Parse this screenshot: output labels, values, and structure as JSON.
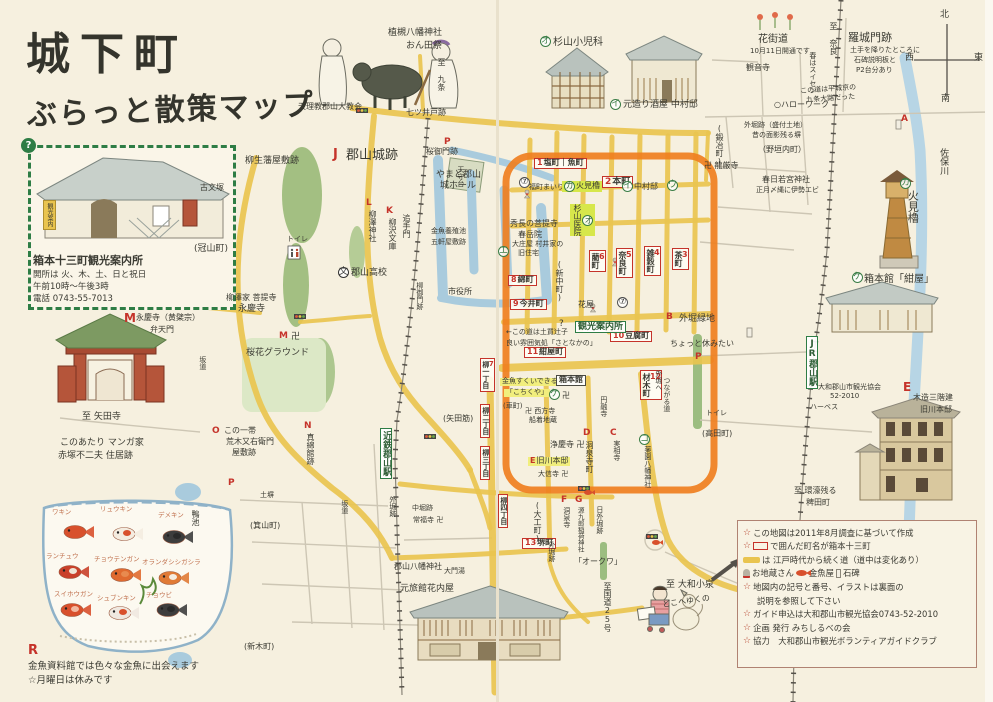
{
  "title": {
    "l1": "城下町",
    "l2": "ぶらっと散策マップ"
  },
  "accent_colors": {
    "road_yellow": "#e9c44f",
    "highlight_orange": "#ef7f1f",
    "box_red": "#c5332a",
    "sign_green": "#2e7d45",
    "water_blue": "#a9cbdd"
  },
  "info": {
    "name": "箱本十三町観光案内所",
    "l1": "開所は 火、木、土、日と祝日",
    "l2": "午前10時～午後3時",
    "l3": "電話 0743-55-7013",
    "banner": "観光案内",
    "q": "?"
  },
  "goldfish": {
    "note_letter": "R",
    "note1": "金魚資料館では色々な金魚に出会えます",
    "note2": "☆月曜日は休みです",
    "fish": [
      {
        "name": "ワキン",
        "lx": 52,
        "ly": 506,
        "fx": 75,
        "fy": 532,
        "c1": "#d8502c",
        "c2": "#d8502c"
      },
      {
        "name": "リュウキン",
        "lx": 100,
        "ly": 503,
        "fx": 124,
        "fy": 534,
        "c1": "#f4ece0",
        "c2": "#d8502c"
      },
      {
        "name": "デメキン",
        "lx": 158,
        "ly": 509,
        "fx": 174,
        "fy": 537,
        "c1": "#3d3d3d",
        "c2": "#2a2a2a"
      },
      {
        "name": "ランチュウ",
        "lx": 46,
        "ly": 550,
        "fx": 70,
        "fy": 572,
        "c1": "#c9402a",
        "c2": "#efe5d5"
      },
      {
        "name": "チョウテンガン",
        "lx": 94,
        "ly": 553,
        "fx": 122,
        "fy": 575,
        "c1": "#e06a2f",
        "c2": "#e88a4f"
      },
      {
        "name": "オランダシシガシラ",
        "lx": 142,
        "ly": 556,
        "fx": 170,
        "fy": 578,
        "c1": "#e07a35",
        "c2": "#f4ece0"
      },
      {
        "name": "スイホウガン",
        "lx": 54,
        "ly": 588,
        "fx": 72,
        "fy": 610,
        "c1": "#d8502c",
        "c2": "#f2b8a0"
      },
      {
        "name": "シュブンキン",
        "lx": 97,
        "ly": 592,
        "fx": 120,
        "fy": 613,
        "c1": "#efe8e0",
        "c2": "#d8502c"
      },
      {
        "name": "チョウビ",
        "lx": 146,
        "ly": 589,
        "fx": 168,
        "fy": 610,
        "c1": "#3d3d3d",
        "c2": "#2a2a2a"
      }
    ]
  },
  "legend": {
    "rows": [
      [
        {
          "i": "star"
        },
        {
          "t": "この地図は2011年8月調査に基づいて作成"
        }
      ],
      [
        {
          "i": "star"
        },
        {
          "i": "rb"
        },
        {
          "t": "で囲んだ町名が箱本十三町"
        }
      ],
      [
        {
          "i": "yb"
        },
        {
          "t": "は 江戸時代から続く道（道中は変化あり）"
        }
      ],
      [
        {
          "i": "jz"
        },
        {
          "t": "お地蔵さん"
        },
        {
          "i": "gf"
        },
        {
          "t": "金魚屋"
        },
        {
          "i": "st"
        },
        {
          "t": "石碑"
        }
      ],
      [
        {
          "i": "star"
        },
        {
          "t": "地図内の記号と番号、イラストは裏面の"
        }
      ],
      [
        {
          "t": "説明を参照して下さい",
          "ind": true
        }
      ],
      [
        {
          "i": "star"
        },
        {
          "t": "ガイド申込は大和郡山市観光協会0743-52-2010"
        }
      ],
      [
        {
          "i": "star"
        },
        {
          "t": "企画 発行 みちしるべの会"
        }
      ],
      [
        {
          "i": "star"
        },
        {
          "t": "協力　大和郡山市観光ボランティアガイドクラブ"
        }
      ]
    ]
  },
  "map_labels": [
    {
      "t": "至 九条",
      "x": 436,
      "y": 58,
      "k": "pv",
      "s": 8
    },
    {
      "t": "植槻八幡神社",
      "x": 388,
      "y": 28,
      "s": 9
    },
    {
      "t": "おん田祭",
      "x": 406,
      "y": 41,
      "s": 9
    },
    {
      "t": "天理教郡山大教会",
      "x": 298,
      "y": 103,
      "s": 8
    },
    {
      "t": "七ツ井戸跡",
      "x": 406,
      "y": 109,
      "s": 8
    },
    {
      "t": "オ",
      "x": 540,
      "y": 36,
      "k": "cg"
    },
    {
      "t": "杉山小児科",
      "x": 553,
      "y": 37,
      "s": 10
    },
    {
      "t": "イ",
      "x": 610,
      "y": 99,
      "k": "cg"
    },
    {
      "t": "元造り酒屋 中村邸",
      "x": 623,
      "y": 100,
      "s": 9
    },
    {
      "t": "卍 龍厳寺",
      "x": 704,
      "y": 162,
      "s": 8
    },
    {
      "t": "(鍛冶町)",
      "x": 714,
      "y": 124,
      "k": "pv",
      "s": 8
    },
    {
      "t": "花街道",
      "x": 758,
      "y": 34,
      "s": 10
    },
    {
      "t": "10月11日開通です",
      "x": 750,
      "y": 48,
      "s": 7
    },
    {
      "t": "観音寺",
      "x": 746,
      "y": 64,
      "s": 8
    },
    {
      "t": "春はスイセン",
      "x": 808,
      "y": 52,
      "k": "pv",
      "s": 7
    },
    {
      "t": "○ハローワーク",
      "x": 774,
      "y": 101,
      "s": 8
    },
    {
      "t": "この道は平城京の",
      "x": 800,
      "y": 88,
      "s": 7,
      "r": -4
    },
    {
      "t": "九条大路だった",
      "x": 806,
      "y": 97,
      "s": 7,
      "r": -4
    },
    {
      "t": "至 奈良",
      "x": 828,
      "y": 22,
      "k": "pv",
      "s": 8
    },
    {
      "t": "羅城門跡",
      "x": 848,
      "y": 32,
      "s": 11
    },
    {
      "t": "土手を降りたところに",
      "x": 850,
      "y": 47,
      "s": 7
    },
    {
      "t": "石碑説明板と",
      "x": 854,
      "y": 57,
      "s": 7
    },
    {
      "t": "P2台分あり",
      "x": 856,
      "y": 67,
      "s": 7
    },
    {
      "t": "A",
      "x": 901,
      "y": 114,
      "k": "rl"
    },
    {
      "t": "北",
      "x": 940,
      "y": 10,
      "s": 9
    },
    {
      "t": "西",
      "x": 905,
      "y": 53,
      "s": 9
    },
    {
      "t": "東",
      "x": 974,
      "y": 53,
      "s": 9
    },
    {
      "t": "南",
      "x": 941,
      "y": 94,
      "s": 9
    },
    {
      "t": "佐保川",
      "x": 938,
      "y": 148,
      "k": "pv",
      "s": 9
    },
    {
      "t": "外堀跡（盛付土地）",
      "x": 744,
      "y": 122,
      "s": 7
    },
    {
      "t": "昔の面影残る塀",
      "x": 752,
      "y": 132,
      "s": 7
    },
    {
      "t": "（野垣内町）",
      "x": 758,
      "y": 146,
      "s": 8
    },
    {
      "t": "春日若宮神社",
      "x": 762,
      "y": 176,
      "s": 8
    },
    {
      "t": "正月〆縄に伊勢エビ",
      "x": 756,
      "y": 187,
      "s": 7
    },
    {
      "t": "カ",
      "x": 900,
      "y": 178,
      "k": "cg"
    },
    {
      "t": "火見櫓",
      "x": 906,
      "y": 190,
      "k": "pv",
      "s": 11
    },
    {
      "t": "ケ",
      "x": 852,
      "y": 272,
      "k": "cg"
    },
    {
      "t": "箱本館「紺屋」",
      "x": 864,
      "y": 274,
      "s": 10
    },
    {
      "t": "E",
      "x": 903,
      "y": 381,
      "k": "rl",
      "s": 12
    },
    {
      "t": "木造三階建",
      "x": 913,
      "y": 394,
      "s": 8
    },
    {
      "t": "旧川本邸",
      "x": 920,
      "y": 406,
      "s": 8
    },
    {
      "t": "JR郡山駅",
      "x": 806,
      "y": 336,
      "k": "gbv",
      "s": 9
    },
    {
      "t": "大和郡山市観光協会",
      "x": 818,
      "y": 384,
      "s": 7
    },
    {
      "t": "52-2010",
      "x": 830,
      "y": 393,
      "s": 7
    },
    {
      "t": "ハーベス",
      "x": 810,
      "y": 404,
      "s": 7
    },
    {
      "t": "至 環濠残る",
      "x": 794,
      "y": 487,
      "s": 8
    },
    {
      "t": "稗田町",
      "x": 806,
      "y": 499,
      "s": 8
    },
    {
      "t": "柳生藩屋敷跡",
      "x": 245,
      "y": 156,
      "s": 9
    },
    {
      "t": "古文塚",
      "x": 200,
      "y": 184,
      "s": 8
    },
    {
      "t": "(冠山町)",
      "x": 194,
      "y": 244,
      "s": 9
    },
    {
      "t": "J",
      "x": 333,
      "y": 148,
      "k": "rl",
      "s": 13
    },
    {
      "t": "郡山城跡",
      "x": 346,
      "y": 149,
      "s": 13
    },
    {
      "t": "天守台",
      "x": 456,
      "y": 166,
      "k": "pv",
      "s": 7
    },
    {
      "t": "L",
      "x": 366,
      "y": 198,
      "k": "rl"
    },
    {
      "t": "柳澤神社",
      "x": 367,
      "y": 210,
      "k": "pv",
      "s": 8
    },
    {
      "t": "K",
      "x": 386,
      "y": 206,
      "k": "rl"
    },
    {
      "t": "柳沢文庫",
      "x": 387,
      "y": 218,
      "k": "pv",
      "s": 8
    },
    {
      "t": "追手門",
      "x": 401,
      "y": 214,
      "k": "pv",
      "s": 8
    },
    {
      "t": "P",
      "x": 444,
      "y": 137,
      "k": "rl"
    },
    {
      "t": "桜御門跡",
      "x": 426,
      "y": 148,
      "s": 8
    },
    {
      "t": "やまと郡山",
      "x": 436,
      "y": 170,
      "s": 9
    },
    {
      "t": "城ホール",
      "x": 440,
      "y": 181,
      "s": 9
    },
    {
      "t": "金魚養殖池",
      "x": 431,
      "y": 228,
      "s": 7
    },
    {
      "t": "五軒屋敷跡",
      "x": 431,
      "y": 239,
      "s": 7
    },
    {
      "t": "市役所",
      "x": 448,
      "y": 288,
      "s": 8
    },
    {
      "t": "柳御門跡",
      "x": 415,
      "y": 282,
      "k": "pv",
      "s": 7
    },
    {
      "t": "文",
      "x": 338,
      "y": 267,
      "k": "cb"
    },
    {
      "t": "郡山高校",
      "x": 351,
      "y": 268,
      "s": 9
    },
    {
      "t": "柳澤家 菩提寺",
      "x": 226,
      "y": 294,
      "s": 8
    },
    {
      "t": "永慶寺",
      "x": 238,
      "y": 304,
      "s": 9
    },
    {
      "t": "M",
      "x": 279,
      "y": 331,
      "k": "rl"
    },
    {
      "t": "卍",
      "x": 291,
      "y": 332,
      "s": 9
    },
    {
      "t": "M",
      "x": 124,
      "y": 312,
      "k": "rl",
      "s": 12
    },
    {
      "t": "永慶寺（黄檗宗）",
      "x": 136,
      "y": 314,
      "s": 8
    },
    {
      "t": "弁天門",
      "x": 150,
      "y": 326,
      "s": 8
    },
    {
      "t": "トイレ",
      "x": 287,
      "y": 236,
      "s": 7
    },
    {
      "t": "桜花グラウンド",
      "x": 246,
      "y": 348,
      "s": 9
    },
    {
      "t": "坂道",
      "x": 198,
      "y": 356,
      "k": "pv",
      "s": 7
    },
    {
      "t": "至 矢田寺",
      "x": 82,
      "y": 412,
      "s": 9
    },
    {
      "t": "このあたり マンガ家",
      "x": 60,
      "y": 438,
      "s": 9
    },
    {
      "t": "赤塚不二夫 住居跡",
      "x": 58,
      "y": 451,
      "s": 9
    },
    {
      "t": "O",
      "x": 212,
      "y": 426,
      "k": "rl"
    },
    {
      "t": "この一帯",
      "x": 224,
      "y": 427,
      "s": 8
    },
    {
      "t": "荒木又右衛門",
      "x": 226,
      "y": 438,
      "s": 8
    },
    {
      "t": "屋敷跡",
      "x": 232,
      "y": 449,
      "s": 8
    },
    {
      "t": "N",
      "x": 304,
      "y": 421,
      "k": "rl"
    },
    {
      "t": "真綿館跡",
      "x": 305,
      "y": 433,
      "k": "pv",
      "s": 8
    },
    {
      "t": "P",
      "x": 228,
      "y": 478,
      "k": "rl"
    },
    {
      "t": "土塀",
      "x": 260,
      "y": 492,
      "s": 7
    },
    {
      "t": "鴨池",
      "x": 190,
      "y": 510,
      "k": "pv",
      "s": 8
    },
    {
      "t": "(箕山町)",
      "x": 250,
      "y": 522,
      "s": 8
    },
    {
      "t": "近鉄郡山駅",
      "x": 380,
      "y": 428,
      "k": "gbv",
      "s": 9
    },
    {
      "t": "外堀跡",
      "x": 388,
      "y": 496,
      "k": "pv",
      "s": 7
    },
    {
      "t": "坂道",
      "x": 340,
      "y": 500,
      "k": "pv",
      "s": 7
    },
    {
      "t": "(矢田筋)",
      "x": 443,
      "y": 415,
      "s": 8
    },
    {
      "t": "中堀跡",
      "x": 412,
      "y": 505,
      "s": 7
    },
    {
      "t": "常福寺 卍",
      "x": 413,
      "y": 517,
      "s": 7
    },
    {
      "t": "郡山八幡神社",
      "x": 394,
      "y": 563,
      "s": 8
    },
    {
      "t": "大門湯",
      "x": 444,
      "y": 568,
      "s": 7
    },
    {
      "t": "元旅館花内屋",
      "x": 400,
      "y": 584,
      "s": 9
    },
    {
      "t": "(新木町)",
      "x": 244,
      "y": 643,
      "s": 8
    },
    {
      "n": "1",
      "t": "塩町｜魚町",
      "x": 534,
      "y": 158,
      "k": "rb",
      "s": 8
    },
    {
      "n": "2",
      "t": "本町",
      "x": 602,
      "y": 176,
      "k": "rb",
      "s": 9
    },
    {
      "n": "3",
      "t": "茶町",
      "x": 672,
      "y": 248,
      "k": "rbv",
      "s": 8
    },
    {
      "n": "4",
      "t": "雑穀町",
      "x": 644,
      "y": 246,
      "k": "rbv",
      "s": 8
    },
    {
      "n": "5",
      "t": "奈良町",
      "x": 616,
      "y": 248,
      "k": "rbv",
      "s": 8
    },
    {
      "n": "6",
      "t": "藺町",
      "x": 589,
      "y": 250,
      "k": "rbv",
      "s": 8
    },
    {
      "n": "7",
      "t": "柳一丁目",
      "x": 480,
      "y": 358,
      "k": "rbv",
      "s": 7
    },
    {
      "t": "柳二丁目",
      "x": 480,
      "y": 404,
      "k": "rbv",
      "s": 7
    },
    {
      "t": "柳三丁目",
      "x": 480,
      "y": 446,
      "k": "rbv",
      "s": 7
    },
    {
      "t": "柳四丁目",
      "x": 498,
      "y": 494,
      "k": "rbv",
      "s": 7
    },
    {
      "n": "8",
      "t": "綿町",
      "x": 508,
      "y": 275,
      "k": "rb",
      "s": 8
    },
    {
      "n": "9",
      "t": "今井町",
      "x": 510,
      "y": 299,
      "k": "rb",
      "s": 8
    },
    {
      "n": "10",
      "t": "豆腐町",
      "x": 610,
      "y": 331,
      "k": "rb",
      "s": 8
    },
    {
      "n": "11",
      "t": "紺屋町",
      "x": 524,
      "y": 347,
      "k": "rb",
      "s": 8
    },
    {
      "n": "12",
      "t": "材木町",
      "x": 640,
      "y": 370,
      "k": "rbv",
      "s": 8
    },
    {
      "n": "13",
      "t": "堺町",
      "x": 522,
      "y": 538,
      "k": "rb",
      "s": 8
    },
    {
      "t": "⑦",
      "x": 519,
      "y": 177,
      "k": "cn"
    },
    {
      "t": "福町まいり",
      "x": 529,
      "y": 184,
      "s": 7
    },
    {
      "n": "カ",
      "t": "火見櫓",
      "x": 562,
      "y": 181,
      "k": "gh",
      "s": 8
    },
    {
      "n": "オ",
      "t": "杉山医院",
      "x": 570,
      "y": 204,
      "k": "ghv",
      "s": 8
    },
    {
      "t": "イ",
      "x": 622,
      "y": 181,
      "k": "cg"
    },
    {
      "t": "中村邸",
      "x": 634,
      "y": 183,
      "s": 8
    },
    {
      "t": "ウ",
      "x": 667,
      "y": 180,
      "k": "cg"
    },
    {
      "t": "エ",
      "x": 498,
      "y": 246,
      "k": "cg"
    },
    {
      "t": "秀長の菩提寺",
      "x": 510,
      "y": 220,
      "s": 8
    },
    {
      "t": "春岳院",
      "x": 518,
      "y": 231,
      "s": 8
    },
    {
      "t": "大庄屋 村井家の",
      "x": 512,
      "y": 241,
      "s": 7
    },
    {
      "t": "旧住宅",
      "x": 518,
      "y": 250,
      "s": 7
    },
    {
      "t": "(新中町)",
      "x": 554,
      "y": 260,
      "k": "pv",
      "s": 8
    },
    {
      "t": "B",
      "x": 666,
      "y": 312,
      "k": "rl"
    },
    {
      "t": "外堀緑地",
      "x": 679,
      "y": 314,
      "s": 9
    },
    {
      "t": "ちょっと休みたい",
      "x": 670,
      "y": 340,
      "s": 8
    },
    {
      "t": "(高田町)",
      "x": 702,
      "y": 430,
      "s": 8
    },
    {
      "t": "花屋",
      "x": 578,
      "y": 301,
      "s": 8
    },
    {
      "t": "⑦",
      "x": 617,
      "y": 297,
      "k": "cn"
    },
    {
      "t": "?",
      "x": 559,
      "y": 319,
      "k": "qm"
    },
    {
      "t": "観光案内所",
      "x": 575,
      "y": 321,
      "k": "gb",
      "s": 9
    },
    {
      "t": "←この道は土買辻子",
      "x": 506,
      "y": 329,
      "s": 7
    },
    {
      "t": "良い雰囲気処「さとなかの」",
      "x": 506,
      "y": 340,
      "s": 7
    },
    {
      "t": "金魚すくいできる",
      "x": 500,
      "y": 378,
      "k": "yh",
      "s": 7
    },
    {
      "t": "「こちくや」",
      "x": 504,
      "y": 389,
      "k": "yh",
      "s": 7
    },
    {
      "t": "箱本館",
      "x": 556,
      "y": 375,
      "k": "bb",
      "s": 8
    },
    {
      "t": "ケ",
      "x": 549,
      "y": 389,
      "k": "cg"
    },
    {
      "t": "卍",
      "x": 562,
      "y": 392,
      "s": 8
    },
    {
      "t": "外堀へ",
      "x": 654,
      "y": 370,
      "k": "pv",
      "s": 7
    },
    {
      "t": "つながる道",
      "x": 662,
      "y": 377,
      "k": "pv",
      "s": 7
    },
    {
      "t": "円融寺",
      "x": 599,
      "y": 396,
      "k": "pv",
      "s": 7
    },
    {
      "t": "(車町)",
      "x": 503,
      "y": 403,
      "s": 7
    },
    {
      "t": "卍 西方寺",
      "x": 525,
      "y": 408,
      "s": 7
    },
    {
      "t": "船着地蔵",
      "x": 529,
      "y": 417,
      "s": 7
    },
    {
      "t": "C",
      "x": 610,
      "y": 428,
      "k": "rl"
    },
    {
      "t": "実相寺",
      "x": 612,
      "y": 440,
      "k": "pv",
      "s": 7
    },
    {
      "t": "D",
      "x": 583,
      "y": 428,
      "k": "rl"
    },
    {
      "t": "洞泉寺町",
      "x": 584,
      "y": 441,
      "k": "pv",
      "s": 8
    },
    {
      "t": "コ",
      "x": 639,
      "y": 434,
      "k": "cg"
    },
    {
      "t": "薬園八幡神社",
      "x": 643,
      "y": 446,
      "k": "pv",
      "s": 7
    },
    {
      "n": "E",
      "t": "旧川本邸",
      "x": 528,
      "y": 457,
      "k": "yh",
      "s": 8
    },
    {
      "t": "大信寺 卍",
      "x": 538,
      "y": 471,
      "s": 7
    },
    {
      "t": "浄慶寺 卍",
      "x": 550,
      "y": 441,
      "s": 8
    },
    {
      "t": "F",
      "x": 561,
      "y": 495,
      "k": "rl"
    },
    {
      "t": "洞泉寺",
      "x": 562,
      "y": 507,
      "k": "pv",
      "s": 7
    },
    {
      "t": "G",
      "x": 575,
      "y": 495,
      "k": "rl"
    },
    {
      "t": "源九郎稲荷神社",
      "x": 576,
      "y": 507,
      "k": "pv",
      "s": 6.5
    },
    {
      "t": "(大工町)",
      "x": 532,
      "y": 501,
      "k": "pv",
      "s": 8
    },
    {
      "t": "外堀跡",
      "x": 547,
      "y": 541,
      "k": "pv",
      "s": 7
    },
    {
      "t": "「オークワ」",
      "x": 574,
      "y": 558,
      "s": 8
    },
    {
      "t": "日外堀跡",
      "x": 595,
      "y": 506,
      "k": "pv",
      "s": 7
    },
    {
      "t": "至国道25号",
      "x": 602,
      "y": 582,
      "k": "pv",
      "s": 8
    },
    {
      "t": "至 大和小泉",
      "x": 666,
      "y": 580,
      "s": 9
    },
    {
      "t": "どこへゆくの",
      "x": 662,
      "y": 601,
      "s": 8,
      "r": -8
    },
    {
      "t": "P",
      "x": 695,
      "y": 352,
      "k": "rl"
    },
    {
      "t": "トイレ",
      "x": 706,
      "y": 410,
      "s": 7
    }
  ]
}
